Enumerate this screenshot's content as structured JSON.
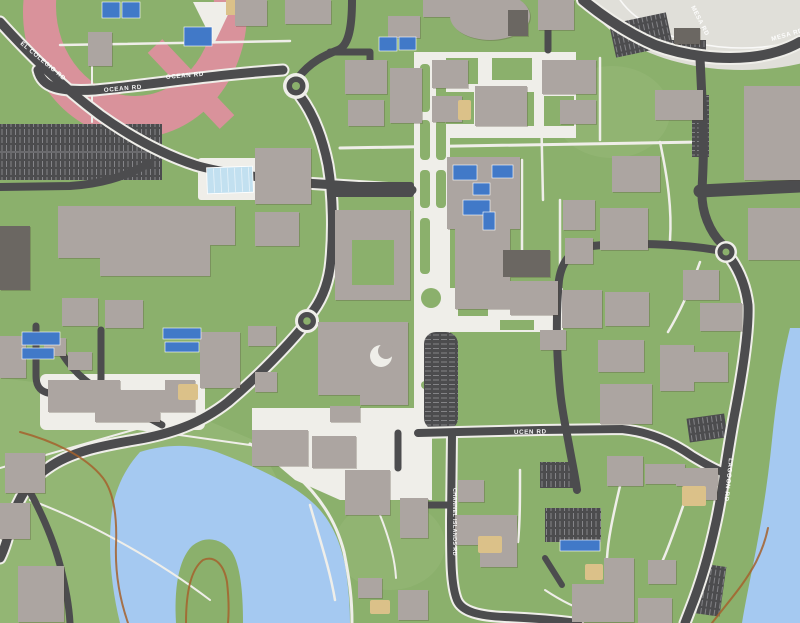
{
  "map": {
    "title": "University campus map",
    "road_labels": [
      {
        "text": "EL COLEGIO RD"
      },
      {
        "text": "OCEAN RD"
      },
      {
        "text": "OCEAN RD"
      },
      {
        "text": "MESA RD"
      },
      {
        "text": "MESA RD"
      },
      {
        "text": "UCEN RD"
      },
      {
        "text": "LAGOON RD"
      },
      {
        "text": "CHANNEL ISLANDS RD"
      }
    ],
    "features": [
      "running-track",
      "tennis-courts",
      "swimming-pool",
      "stadium-field",
      "campus-lagoon",
      "lagoon-island",
      "ocean-shore",
      "solar-roofs",
      "parking-lots",
      "roundabouts",
      "dirt-trails"
    ]
  },
  "colors": {
    "grass": "#8BB06C",
    "grass_light": "#9ABC7C",
    "grass_dark": "#7CA25E",
    "building": "#ACA5A1",
    "building_dark": "#6B6762",
    "road": "#4C4C4E",
    "road_stripe": "#8A8A8E",
    "path": "#EFEEE9",
    "water": "#A5C9F1",
    "pool": "#C2E0F0",
    "solar": "#4179C8",
    "track": "#D9929B",
    "field": "#E0DFD9",
    "sand": "#DBC189",
    "trail": "#A5622D",
    "label": "#FFFFFF"
  }
}
